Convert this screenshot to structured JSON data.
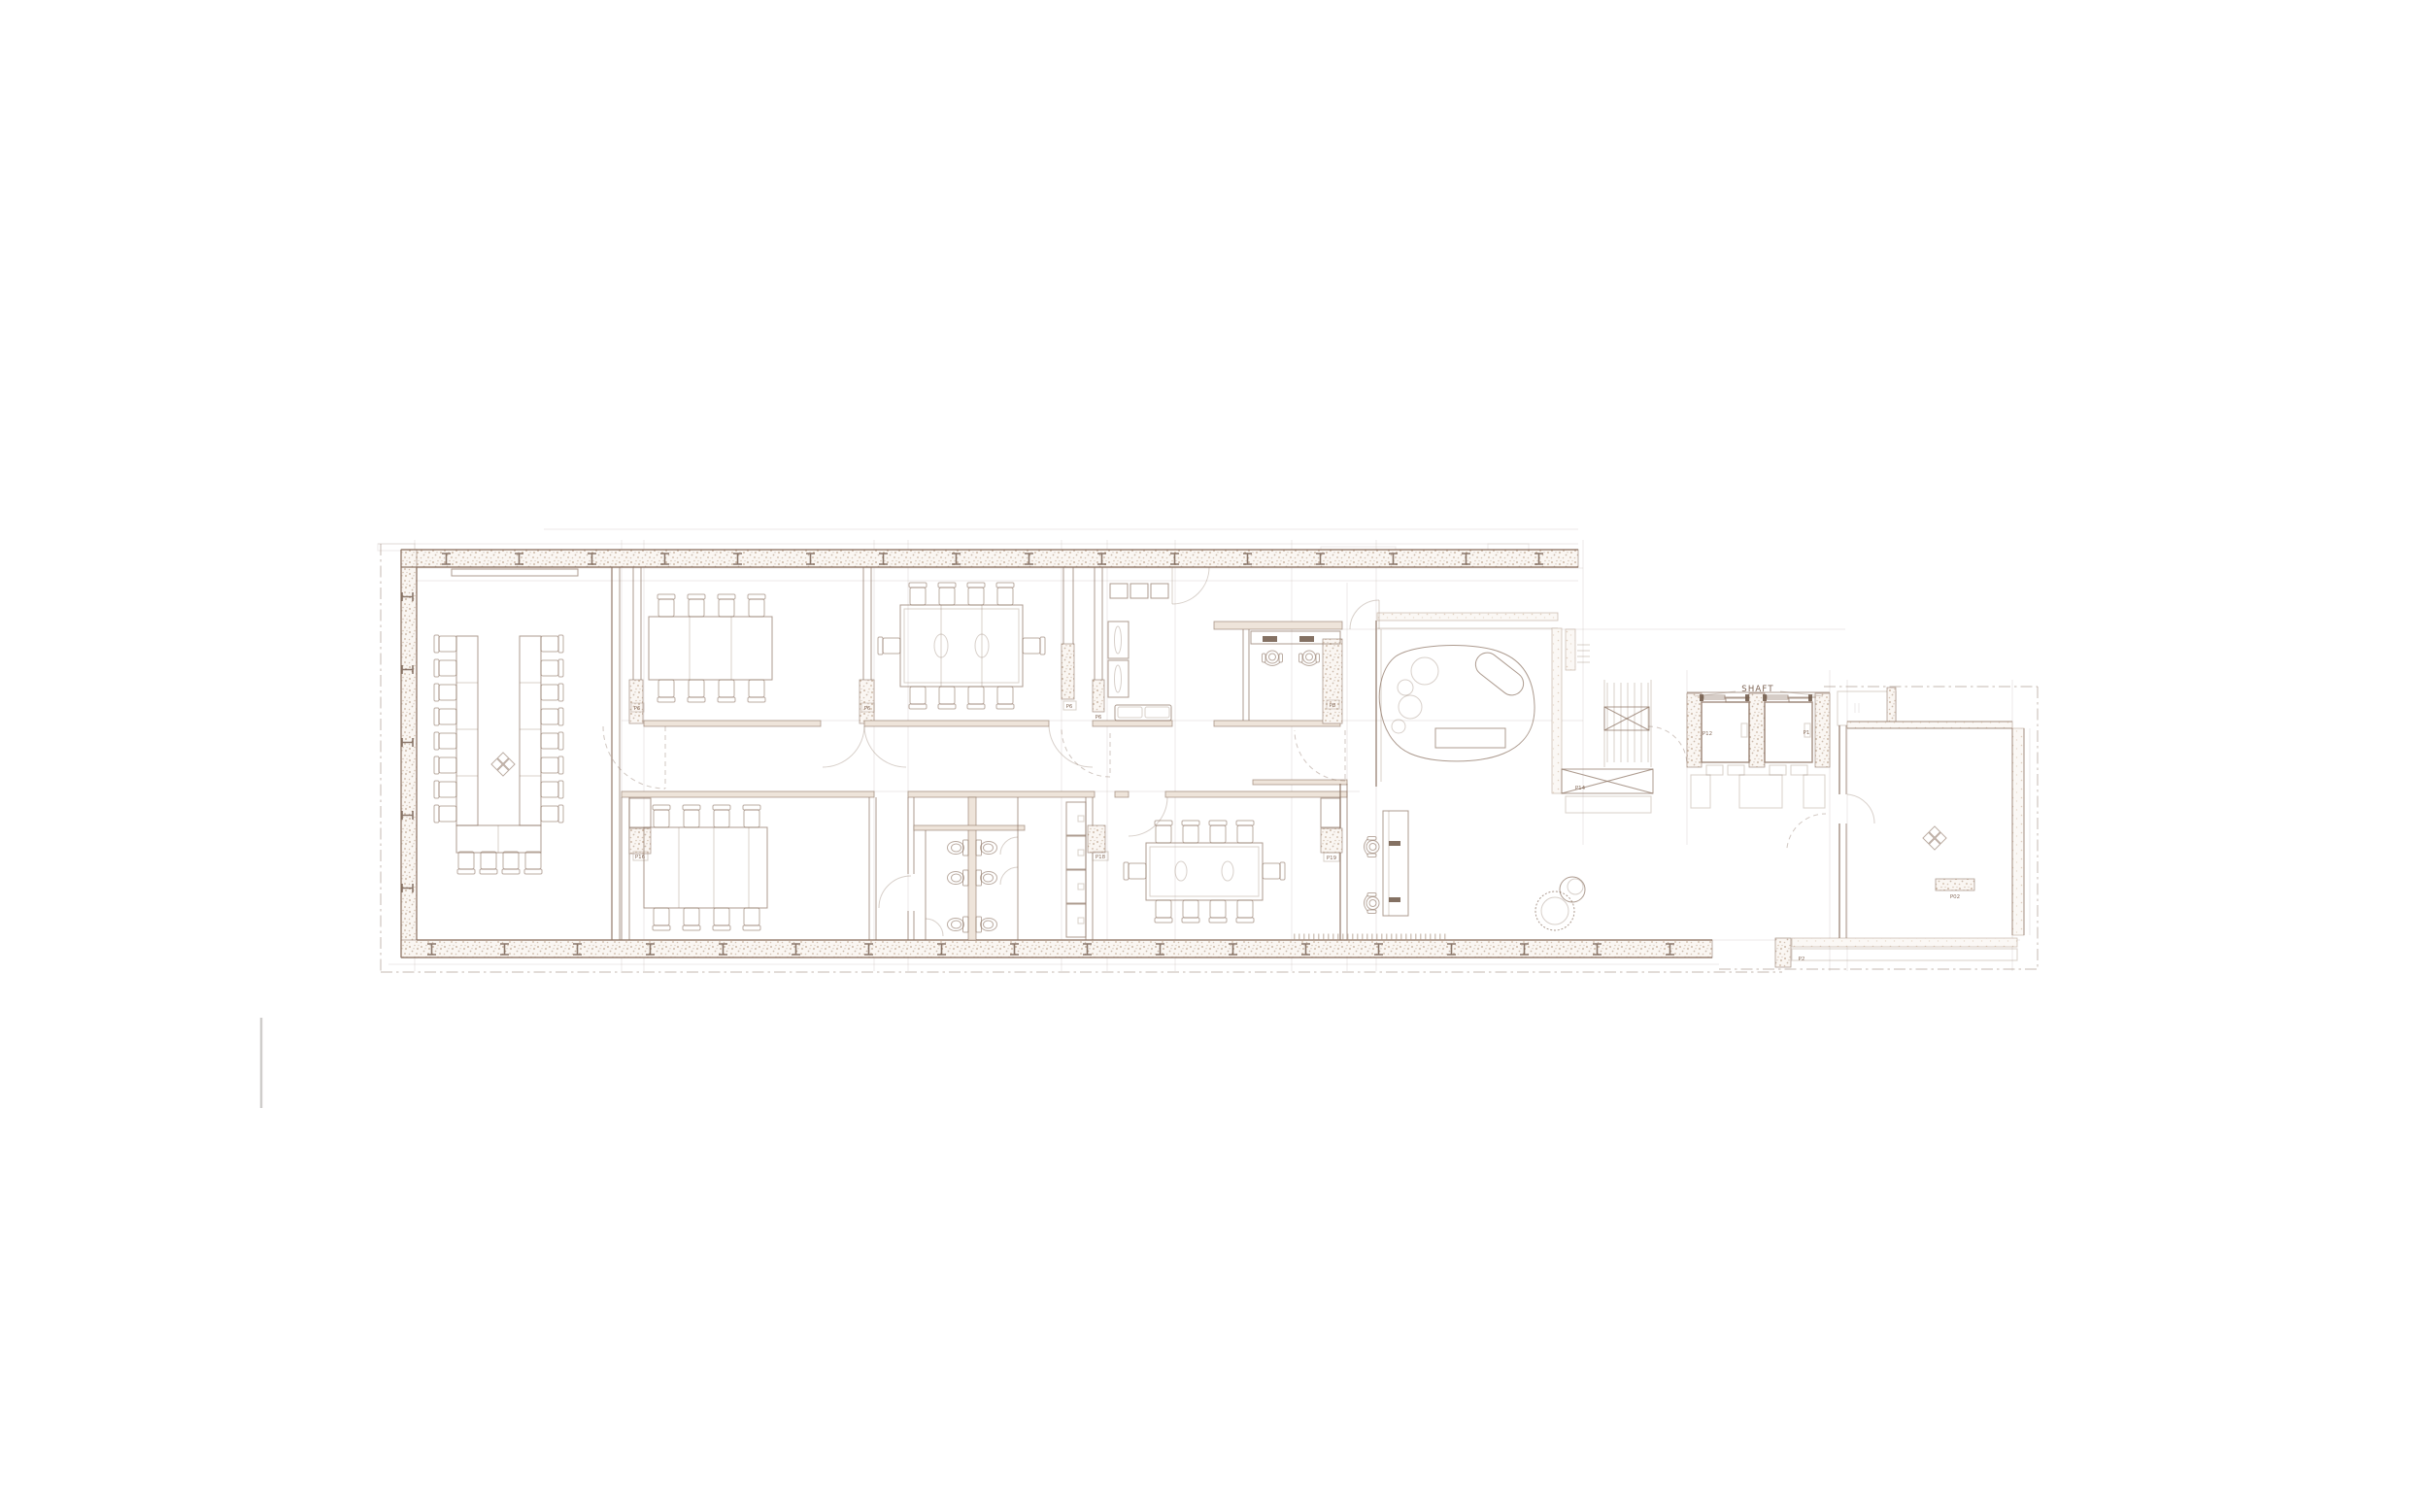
{
  "plan": {
    "elevator_label": "SHAFT",
    "tags": {
      "p6_a": "P6",
      "p6_b": "P6",
      "p6_c": "P6",
      "p6_d": "P6",
      "p8": "P8",
      "p16": "P16",
      "p18": "P18",
      "p19": "P19",
      "p14": "P14",
      "p12": "P12",
      "p1": "P1",
      "p2": "P2",
      "p02": "P02"
    },
    "colors": {
      "ink": "#8d7464",
      "ink_light": "#b59c8a",
      "wall_speckle": "#a9886b",
      "dark_mark": "#6f5848",
      "window_hatch": "#cfb6a0",
      "stray_line": "#cfcdcb"
    }
  }
}
